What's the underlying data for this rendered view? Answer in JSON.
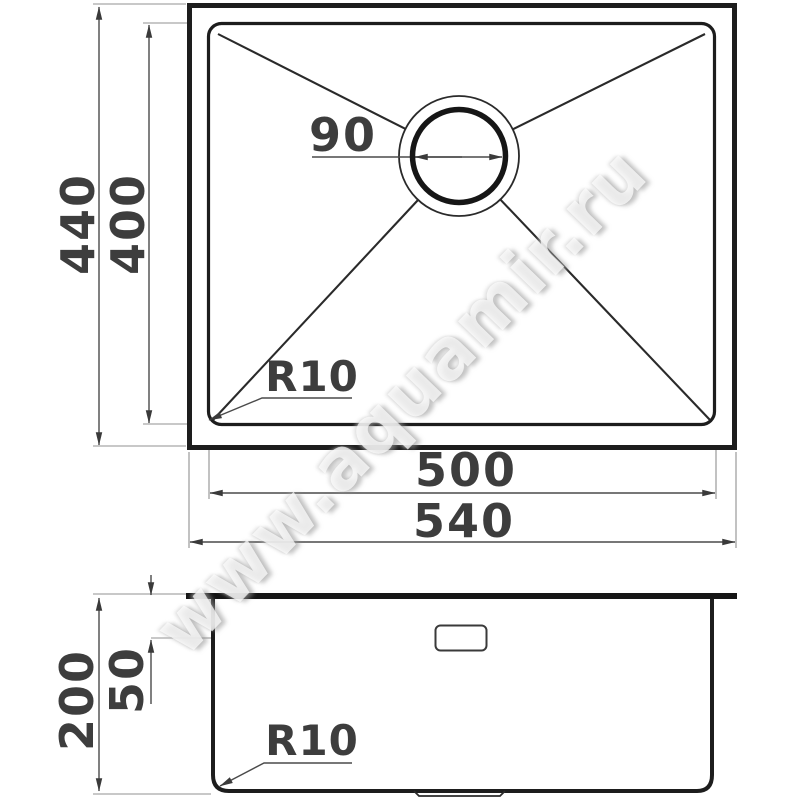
{
  "title": "sink-technical-drawing",
  "watermark": {
    "text": "www.aquamir.ru"
  },
  "colors": {
    "line": "#1d1d1d",
    "dimension_line": "#4a4a4a",
    "label_text": "#3d3d3d",
    "background": "#ffffff"
  },
  "top_view": {
    "dims": {
      "outer_height": "440",
      "inner_height": "400",
      "drain_diameter": "90",
      "corner_radius": "R10",
      "inner_width": "500",
      "outer_width": "540"
    }
  },
  "side_view": {
    "dims": {
      "total_depth": "200",
      "overflow_offset": "50",
      "corner_radius": "R10"
    }
  }
}
